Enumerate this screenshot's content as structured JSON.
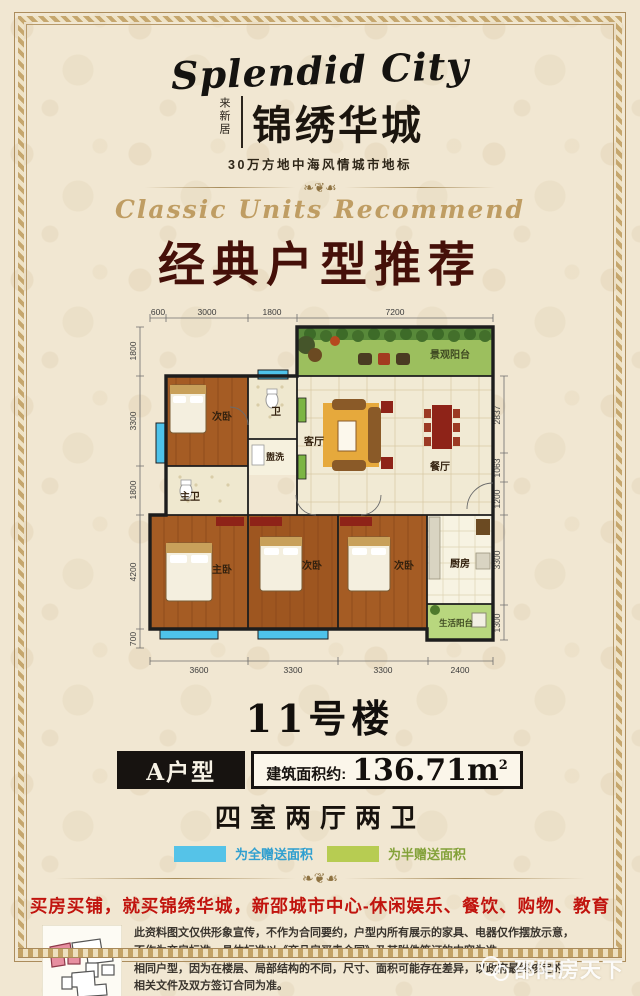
{
  "header": {
    "logo_en": "Splendid City",
    "logo_vertical": "来新居",
    "logo_cn": "锦绣华城",
    "tagline": "30万方地中海风情城市地标"
  },
  "section": {
    "subtitle_en": "Classic Units Recommend",
    "title_cn": "经典户型推荐"
  },
  "plan": {
    "dims_top": [
      "600",
      "3000",
      "1800",
      "7200"
    ],
    "dims_left": [
      "1800",
      "3300",
      "1800",
      "4200",
      "700"
    ],
    "dims_right": [
      "2837",
      "1063",
      "1200",
      "3300",
      "1300"
    ],
    "dims_bottom": [
      "3600",
      "3300",
      "3300",
      "2400"
    ],
    "rooms": {
      "view_balcony": "景观阳台",
      "bed_top": "次卧",
      "bath": "卫",
      "wash": "盥洗",
      "living": "客厅",
      "dining": "餐厅",
      "master_bath": "主卫",
      "master_bed": "主卧",
      "bed_mid": "次卧",
      "bed_right": "次卧",
      "kitchen": "厨房",
      "life_balcony": "生活阳台"
    }
  },
  "unit": {
    "building": "11号楼",
    "type_label": "A户型",
    "area_label": "建筑面积约:",
    "area_value": "136.71m",
    "area_sup": "2",
    "layout": "四室两厅两卫"
  },
  "legend": {
    "full_gift": "为全赠送面积",
    "half_gift": "为半赠送面积",
    "full_color": "#55c3e8",
    "half_color": "#b7cc52"
  },
  "footer": {
    "headline": "买房买铺，就买锦绣华城，新邵城市中心-休闲娱乐、餐饮、购物、教育",
    "disclaimer_lines": [
      "此资料图文仅供形象宣传，不作为合同要约，户型内所有展示的家具、电器仅作摆放示意，",
      "不作为交房标准，具体标准以《商品房买卖合同》及其附件签订的内容为准。",
      "相同户型，因为在楼层、局部结构的不同，尺寸、面积可能存在差异，以政府最终核定的",
      "相关文件及双方签订合同为准。"
    ],
    "watermark": "邵阳房天下"
  },
  "colors": {
    "title_maroon": "#451009",
    "headline_red": "#c1140e",
    "gold_accent": "#bf9d63",
    "balcony_green": "#9cbf5e",
    "life_balcony_green": "#b8d77e",
    "gift_blue": "#4ec3ea",
    "wood_floor": "#a55c24"
  }
}
